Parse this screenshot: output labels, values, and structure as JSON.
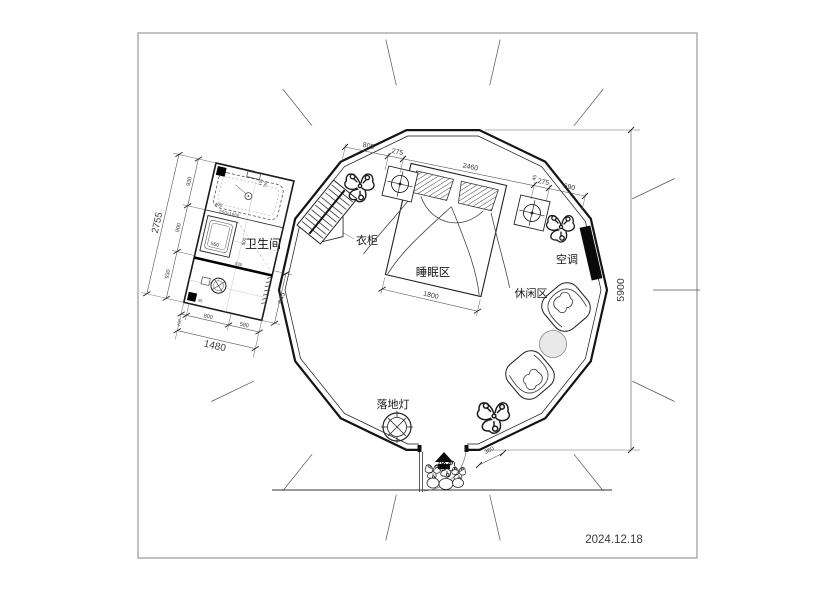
{
  "title_block": {
    "date": "2024.12.18"
  },
  "rooms": {
    "bathroom": "卫生间",
    "sleeping": "睡眠区",
    "leisure": "休闲区"
  },
  "items": {
    "wardrobe": "衣柜",
    "air_conditioner": "空调",
    "floor_lamp": "落地灯"
  },
  "dimensions": {
    "overall_height": "5900",
    "top_chain": [
      "805",
      "275",
      "2460",
      "45",
      "275",
      "690"
    ],
    "bed_width": "1800",
    "entry": "360",
    "bathroom": {
      "left_total": "2755",
      "left_chain": [
        "930",
        "900",
        "930"
      ],
      "bottom_total": "1480",
      "bottom_chain": [
        "100",
        "800",
        "580"
      ],
      "door": "945",
      "inner_sink": "550",
      "inner_depth": "900",
      "inner_width": "930",
      "inner_tub": "400",
      "inner_small_a": "150",
      "inner_small_b": "750",
      "inner_corner": "95",
      "tub_note": "550x1600"
    }
  }
}
